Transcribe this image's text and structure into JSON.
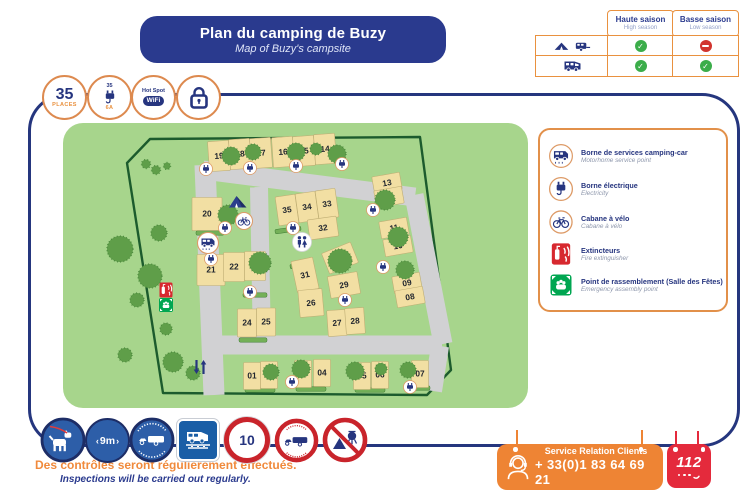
{
  "header": {
    "title_fr": "Plan du camping de Buzy",
    "subtitle_en": "Map of Buzy's campsite"
  },
  "season_table": {
    "col1": {
      "fr": "Haute saison",
      "en": "High season"
    },
    "col2": {
      "fr": "Basse saison",
      "en": "Low season"
    },
    "rows": [
      {
        "name": "tent-and-caravan",
        "high": "allowed",
        "low": "forbidden"
      },
      {
        "name": "motorhome",
        "high": "allowed",
        "low": "allowed"
      }
    ]
  },
  "badges": {
    "places": {
      "value": "35",
      "label": "PLACES"
    },
    "power": {
      "top": "35",
      "bottom": "6A"
    },
    "hotspot": {
      "top": "Hot Spot",
      "label": "WiFi"
    }
  },
  "legend": {
    "items": [
      {
        "icon": "motorhome-service-icon",
        "fr": "Borne de services camping-car",
        "en": "Motorhome service point"
      },
      {
        "icon": "electric-point-icon",
        "fr": "Borne électrique",
        "en": "Electricity"
      },
      {
        "icon": "bike-shed-icon",
        "fr": "Cabane à vélo",
        "en": "Cabane à vélo"
      },
      {
        "icon": "fire-extinguisher-icon",
        "fr": "Extincteurs",
        "en": "Fire extinguisher"
      },
      {
        "icon": "assembly-point-icon",
        "fr": "Point de rassemblement (Salle des Fêtes)",
        "en": "Emergency assembly point"
      }
    ]
  },
  "map": {
    "plots": [
      {
        "n": "19",
        "x": 156,
        "y": 33,
        "w": 21,
        "h": 30,
        "r": -4
      },
      {
        "n": "18",
        "x": 177,
        "y": 31,
        "w": 21,
        "h": 30,
        "r": -4
      },
      {
        "n": "17",
        "x": 198,
        "y": 30,
        "w": 21,
        "h": 30,
        "r": -4
      },
      {
        "n": "16",
        "x": 220,
        "y": 29,
        "w": 21,
        "h": 30,
        "r": -4
      },
      {
        "n": "15",
        "x": 241,
        "y": 28,
        "w": 21,
        "h": 30,
        "r": -4
      },
      {
        "n": "14",
        "x": 262,
        "y": 26,
        "w": 21,
        "h": 30,
        "r": -4
      },
      {
        "n": "20",
        "x": 144,
        "y": 91,
        "w": 30,
        "h": 33,
        "r": 0
      },
      {
        "n": "21",
        "x": 148,
        "y": 147,
        "w": 28,
        "h": 31,
        "r": 0
      },
      {
        "n": "22",
        "x": 171,
        "y": 144,
        "w": 21,
        "h": 29,
        "r": 0
      },
      {
        "n": "23",
        "x": 192,
        "y": 143,
        "w": 21,
        "h": 29,
        "r": 0
      },
      {
        "n": "24",
        "x": 184,
        "y": 200,
        "w": 19,
        "h": 28,
        "r": 0
      },
      {
        "n": "25",
        "x": 203,
        "y": 199,
        "w": 19,
        "h": 28,
        "r": 0
      },
      {
        "n": "35",
        "x": 224,
        "y": 87,
        "w": 20,
        "h": 29,
        "r": -8
      },
      {
        "n": "34",
        "x": 244,
        "y": 84,
        "w": 20,
        "h": 29,
        "r": -8
      },
      {
        "n": "33",
        "x": 264,
        "y": 81,
        "w": 20,
        "h": 29,
        "r": -8
      },
      {
        "n": "32",
        "x": 260,
        "y": 105,
        "w": 29,
        "h": 20,
        "r": -8
      },
      {
        "n": "31",
        "x": 242,
        "y": 152,
        "w": 22,
        "h": 32,
        "r": -12
      },
      {
        "n": "30",
        "x": 277,
        "y": 135,
        "w": 31,
        "h": 22,
        "r": -22
      },
      {
        "n": "29",
        "x": 281,
        "y": 162,
        "w": 30,
        "h": 22,
        "r": -10
      },
      {
        "n": "26",
        "x": 248,
        "y": 180,
        "w": 24,
        "h": 27,
        "r": -5
      },
      {
        "n": "27",
        "x": 274,
        "y": 200,
        "w": 19,
        "h": 26,
        "r": -4
      },
      {
        "n": "28",
        "x": 292,
        "y": 198,
        "w": 19,
        "h": 26,
        "r": -4
      },
      {
        "n": "13",
        "x": 324,
        "y": 60,
        "w": 28,
        "h": 17,
        "r": -10
      },
      {
        "n": "12",
        "x": 326,
        "y": 74,
        "w": 28,
        "h": 17,
        "r": -10
      },
      {
        "n": "11",
        "x": 331,
        "y": 105,
        "w": 28,
        "h": 17,
        "r": -10
      },
      {
        "n": "10",
        "x": 335,
        "y": 123,
        "w": 28,
        "h": 17,
        "r": -10
      },
      {
        "n": "09",
        "x": 344,
        "y": 160,
        "w": 28,
        "h": 17,
        "r": -10
      },
      {
        "n": "08",
        "x": 347,
        "y": 174,
        "w": 28,
        "h": 17,
        "r": -10
      },
      {
        "n": "01",
        "x": 189,
        "y": 253,
        "w": 17,
        "h": 27,
        "r": 0
      },
      {
        "n": "02",
        "x": 206,
        "y": 252,
        "w": 17,
        "h": 27,
        "r": 0
      },
      {
        "n": "03",
        "x": 240,
        "y": 251,
        "w": 17,
        "h": 27,
        "r": 0
      },
      {
        "n": "04",
        "x": 259,
        "y": 250,
        "w": 17,
        "h": 27,
        "r": 0
      },
      {
        "n": "05",
        "x": 299,
        "y": 253,
        "w": 17,
        "h": 27,
        "r": 0
      },
      {
        "n": "06",
        "x": 317,
        "y": 252,
        "w": 17,
        "h": 27,
        "r": 0
      },
      {
        "n": "07",
        "x": 357,
        "y": 251,
        "w": 17,
        "h": 27,
        "r": 0
      }
    ],
    "electric_points": [
      [
        143,
        46
      ],
      [
        187,
        45
      ],
      [
        233,
        43
      ],
      [
        279,
        41
      ],
      [
        162,
        105
      ],
      [
        148,
        136
      ],
      [
        187,
        169
      ],
      [
        230,
        105
      ],
      [
        282,
        177
      ],
      [
        310,
        87
      ],
      [
        320,
        144
      ],
      [
        229,
        259
      ],
      [
        347,
        264
      ]
    ],
    "features": [
      {
        "icon": "tent-icon",
        "x": 175,
        "y": 79
      },
      {
        "icon": "bike-shed-icon",
        "x": 181,
        "y": 98
      },
      {
        "icon": "motorhome-service-icon",
        "x": 145,
        "y": 120
      },
      {
        "icon": "toilets-icon",
        "x": 239,
        "y": 119
      },
      {
        "icon": "fire-extinguisher-icon",
        "x": 103,
        "y": 167
      },
      {
        "icon": "assembly-point-icon",
        "x": 103,
        "y": 182
      },
      {
        "icon": "two-way-arrow-icon",
        "x": 137,
        "y": 244
      }
    ]
  },
  "signs": [
    {
      "name": "dog-on-leash-sign"
    },
    {
      "name": "max-length-9m-sign",
      "label": "9m"
    },
    {
      "name": "car-caravan-allowed-sign"
    },
    {
      "name": "motorhome-service-area-sign"
    },
    {
      "name": "speed-limit-sign",
      "label": "10"
    },
    {
      "name": "no-car-caravan-sign"
    },
    {
      "name": "no-camping-fire-sign"
    }
  ],
  "footer": {
    "note_fr": "Des contrôles seront régulièrement effectués.",
    "note_en": "Inspections will be carried out regularly."
  },
  "contact": {
    "label": "Service Relation Clients",
    "phone": "+ 33(0)1 83 64 69 21",
    "emergency_number": "112"
  },
  "colors": {
    "navy": "#25367e",
    "orange": "#e9913f",
    "map_green": "#a7d58c",
    "fence_green": "#1c5b2d",
    "plot_tan": "#f2dfa3",
    "road_gray": "#d1d1d3",
    "check_green": "#3bad4a",
    "forbid_red": "#d1342e",
    "sign_blue": "#2d5ea8",
    "prohibition_red": "#c9242b",
    "emergency_red": "#e42a3c",
    "contact_orange": "#ee8434"
  }
}
